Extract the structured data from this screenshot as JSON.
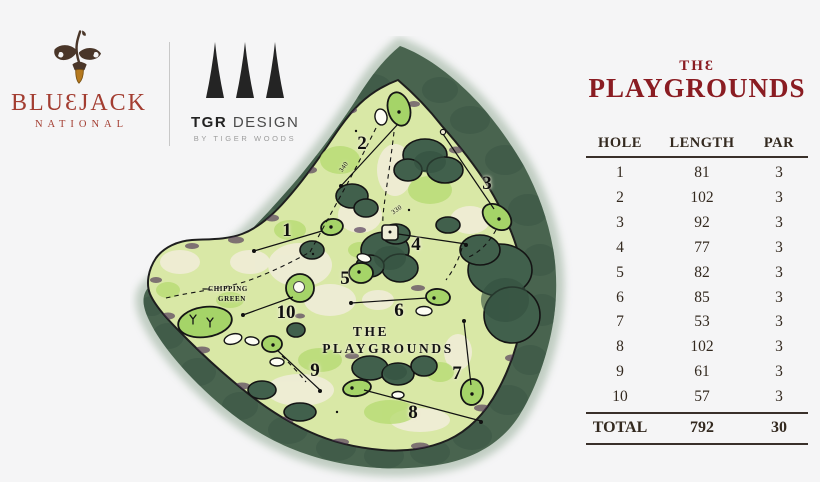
{
  "brand": {
    "name": "BLUƐJACK",
    "subtitle": "NATIONAL",
    "acorn_icon": "acorn-oak-leaves-icon",
    "color": "#a33d31"
  },
  "designer": {
    "name_bold": "TGR",
    "name_rest": "DESIGN",
    "tagline": "BY TIGER WOODS",
    "trees_icon": "three-pine-trees-icon"
  },
  "scorecard": {
    "title_line1": "THƐ",
    "title_line2": "PLAYGROUNDS",
    "title_color": "#8a1c22",
    "columns": [
      "HOLE",
      "LENGTH",
      "PAR"
    ],
    "rows": [
      {
        "hole": "1",
        "length": "81",
        "par": "3"
      },
      {
        "hole": "2",
        "length": "102",
        "par": "3"
      },
      {
        "hole": "3",
        "length": "92",
        "par": "3"
      },
      {
        "hole": "4",
        "length": "77",
        "par": "3"
      },
      {
        "hole": "5",
        "length": "82",
        "par": "3"
      },
      {
        "hole": "6",
        "length": "85",
        "par": "3"
      },
      {
        "hole": "7",
        "length": "53",
        "par": "3"
      },
      {
        "hole": "8",
        "length": "102",
        "par": "3"
      },
      {
        "hole": "9",
        "length": "61",
        "par": "3"
      },
      {
        "hole": "10",
        "length": "57",
        "par": "3"
      }
    ],
    "total": {
      "label": "TOTAL",
      "length": "792",
      "par": "30"
    }
  },
  "map": {
    "hole_numbers": [
      "1",
      "2",
      "3",
      "4",
      "5",
      "6",
      "7",
      "8",
      "9",
      "10"
    ],
    "labels": {
      "chipping_line1": "CHIPPING",
      "chipping_line2": "GREEN",
      "title_line1": "THE",
      "title_line2": "PLAYGROUNDS",
      "yardage_a": "340",
      "yardage_b": "330"
    },
    "colors": {
      "forest_green": "#49644f",
      "fairway_green": "#d9e8a6",
      "putting_green": "#a5d468",
      "ink": "#141414",
      "purple_accent": "#4d3457"
    }
  },
  "background_color": "#f5f5f6"
}
